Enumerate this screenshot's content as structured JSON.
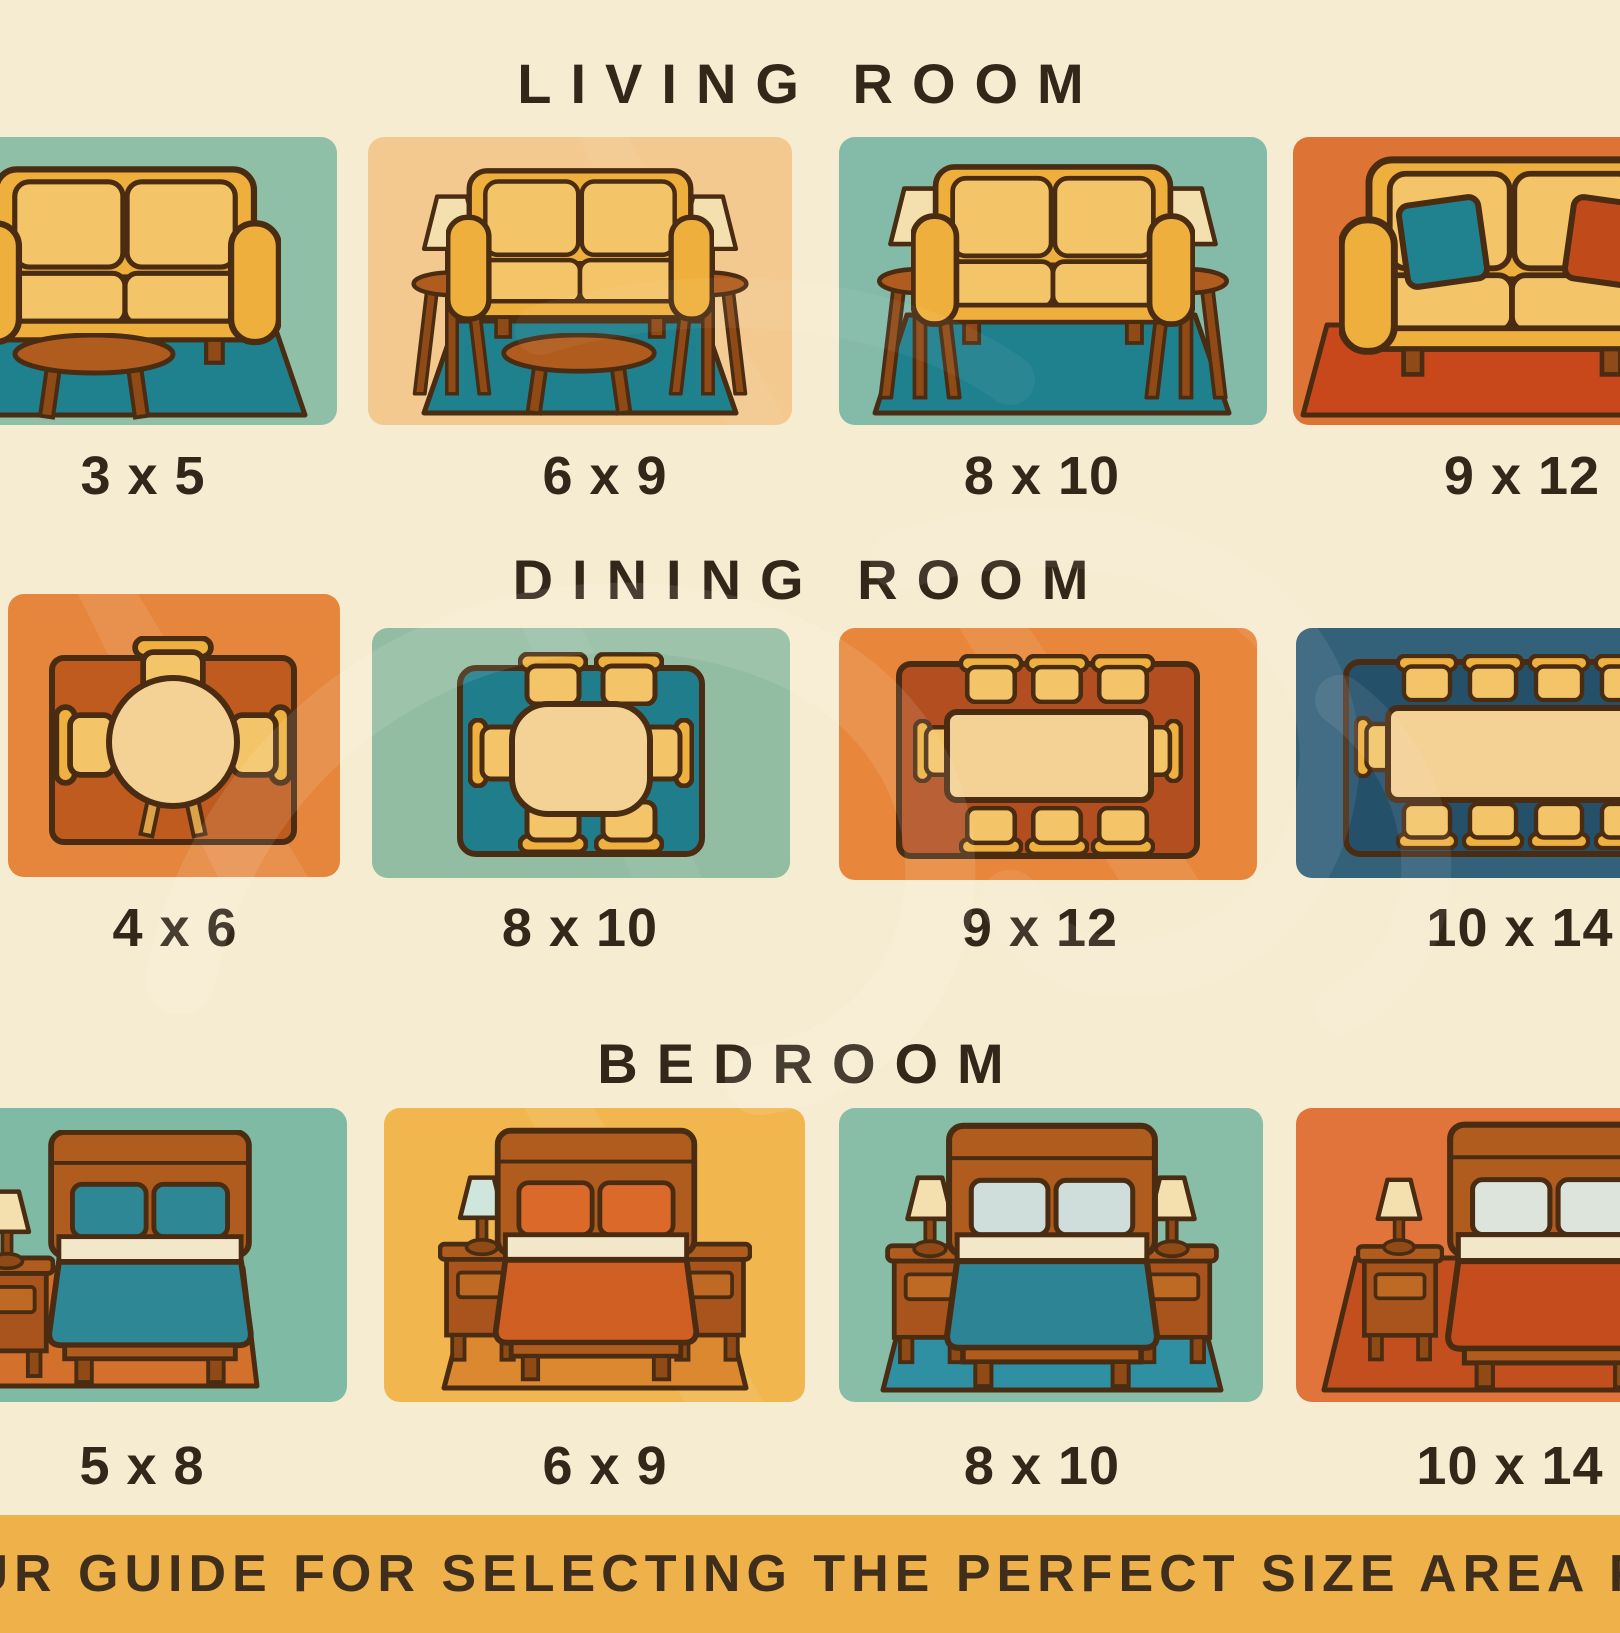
{
  "poster": {
    "background_color": "#f6ecd1",
    "ink_color": "#33271a",
    "sections": [
      {
        "title": "LIVING ROOM",
        "tiles": [
          {
            "size": "3 x 5",
            "scene": "loveseat with coffee table on small teal rug",
            "bg_color": "#8fc0a7",
            "rug_color": "#1f808e"
          },
          {
            "size": "6 x 9",
            "scene": "loveseat, two lamp side tables, coffee table on teal rug",
            "bg_color": "#f3c98f",
            "rug_color": "#1f808e"
          },
          {
            "size": "8 x 10",
            "scene": "loveseat flanked by two lamp tables on teal rug",
            "bg_color": "#83bba8",
            "rug_color": "#1f808e"
          },
          {
            "size": "9 x 12",
            "scene": "large sofa with throw pillows on red-orange rug",
            "bg_color": "#dd7436",
            "rug_color": "#c8481c",
            "pillow_left_color": "#20818f",
            "pillow_right_color": "#c14a1a"
          }
        ]
      },
      {
        "title": "DINING ROOM",
        "tiles": [
          {
            "size": "4 x 6",
            "scene": "round table with four chairs, top view",
            "bg_color": "#e6863c",
            "rug_color": "#bf5b1e"
          },
          {
            "size": "8 x 10",
            "scene": "table with six chairs, top view",
            "bg_color": "#92bda2",
            "rug_color": "#1f7d8c"
          },
          {
            "size": "9 x 12",
            "scene": "table with eight chairs, top view",
            "bg_color": "#e8873c",
            "rug_color": "#b34e20"
          },
          {
            "size": "10 x 14",
            "scene": "long table with ten chairs, top view",
            "bg_color": "#33617a",
            "rug_color": "#24506a"
          }
        ]
      },
      {
        "title": "BEDROOM",
        "tiles": [
          {
            "size": "5 x 8",
            "scene": "bed with teal bedding, nightstand and lamp at left",
            "bg_color": "#7fbaa4",
            "rug_color": "#d2702c",
            "duvet_color": "#2e8794",
            "pillow_color": "#2e8794",
            "shade_color": "#f3e0ae"
          },
          {
            "size": "6 x 9",
            "scene": "bed with orange bedding, two nightstands, teal lamp",
            "bg_color": "#f2b64f",
            "rug_color": "#dc8830",
            "duvet_color": "#d05f24",
            "pillow_color": "#db6a2a",
            "shade_color": "#cfe6dd"
          },
          {
            "size": "8 x 10",
            "scene": "bed with teal bedding, two nightstands with lamps",
            "bg_color": "#88bda7",
            "rug_color": "#2f8fa3",
            "duvet_color": "#2d8494",
            "pillow_color": "#cfdeda",
            "shade_color": "#f3e0ae"
          },
          {
            "size": "10 x 14",
            "scene": "bed with red bedding, nightstand with lamp at left",
            "bg_color": "#e0743a",
            "rug_color": "#c34e1e",
            "duvet_color": "#c54d1d",
            "pillow_color": "#dce4dc",
            "shade_color": "#f3e0ae"
          }
        ]
      }
    ],
    "banner": {
      "text": "OUR GUIDE FOR SELECTING THE PERFECT SIZE AREA RU",
      "background_color": "#efb24b",
      "text_color": "#3f2e1b"
    }
  }
}
